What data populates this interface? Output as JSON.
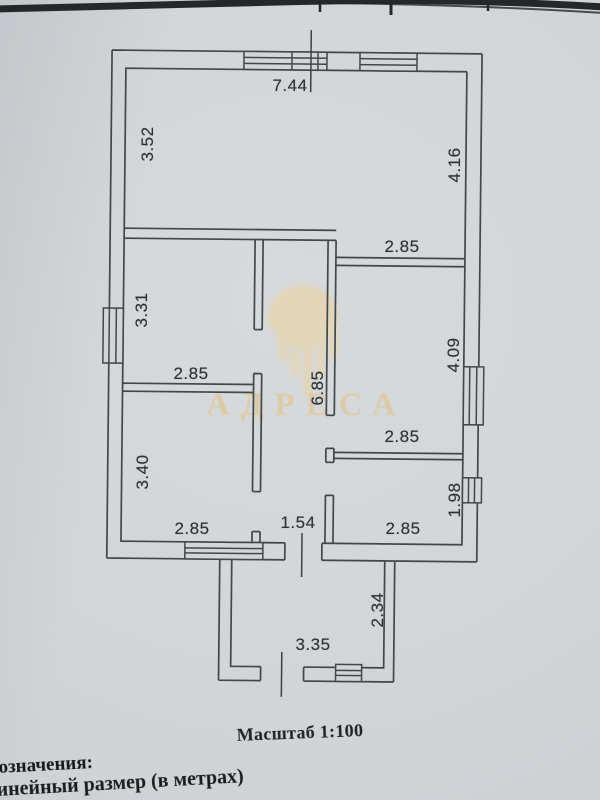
{
  "document_type": "scanned floor plan page",
  "colors": {
    "paper": "#d2d5d8",
    "line": "#43464a",
    "watermark_gold": "#e2c284",
    "text_dark": "#1f2124"
  },
  "watermark": {
    "text": "АДРЕСА"
  },
  "plan": {
    "scale": "1:100",
    "dim_labels": {
      "top_width": "7.44",
      "living_left_height": "3.52",
      "living_right_height": "4.16",
      "room_top_right_width": "2.85",
      "room_mid_left_height": "3.31",
      "room_mid_left_width": "2.85",
      "hall_height": "6.85",
      "room_right_height": "4.09",
      "room_right_width": "2.85",
      "room_bottom_left_height": "3.40",
      "room_bottom_left_width": "2.85",
      "hall_width": "1.54",
      "room_bottom_right_height": "1.98",
      "room_bottom_right_width": "2.85",
      "porch_height": "2.34",
      "porch_width": "3.35"
    }
  },
  "footer": {
    "scale_label": "Масштаб 1:100",
    "legend_heading_partial": "означения:",
    "legend_item_partial": "инейный размер (в метрах)"
  }
}
